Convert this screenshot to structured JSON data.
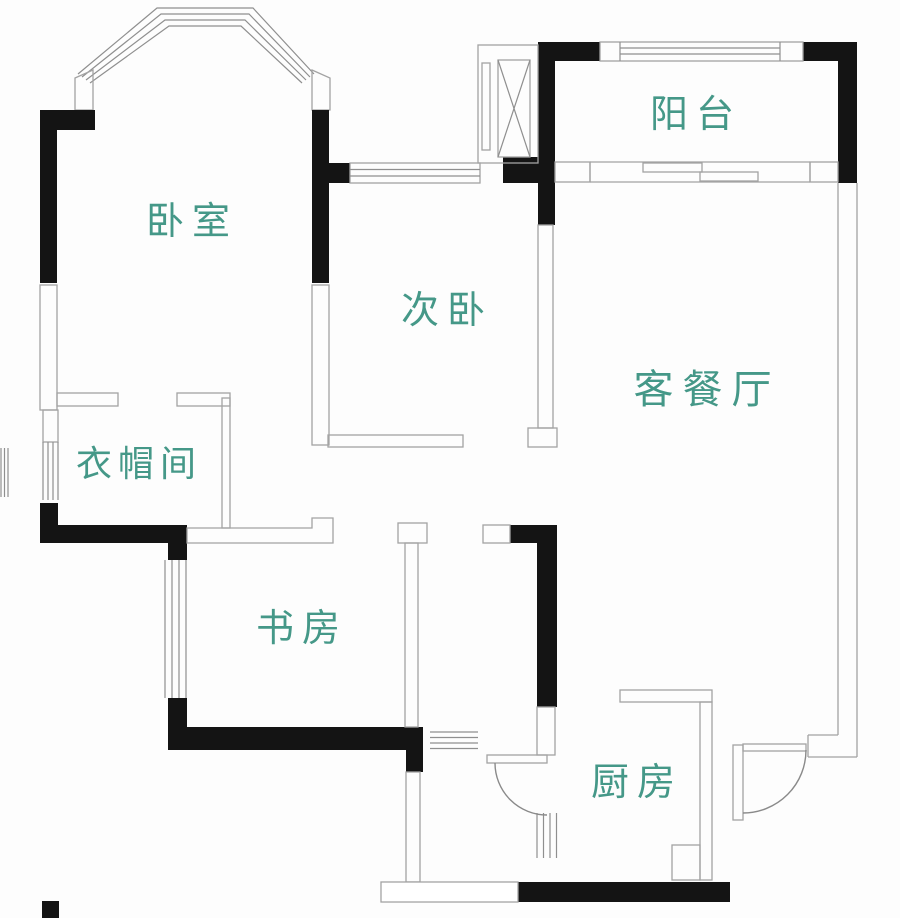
{
  "plan_title": "two-bedroom apartment floor plan",
  "colors": {
    "wall-color": "#141414",
    "line-color": "#a3a3a3",
    "label-color": "#459888",
    "bg-color": "#fdfdfd"
  },
  "rooms": [
    {
      "id": "master-bedroom",
      "name": "卧室"
    },
    {
      "id": "second-bedroom",
      "name": "次卧"
    },
    {
      "id": "balcony",
      "name": "阳台"
    },
    {
      "id": "living-dining",
      "name": "客餐厅"
    },
    {
      "id": "cloakroom",
      "name": "衣帽间"
    },
    {
      "id": "study",
      "name": "书房"
    },
    {
      "id": "kitchen",
      "name": "厨房"
    }
  ],
  "symbols": [
    {
      "id": "bay-window",
      "meaning": "bay window with four glazing lines"
    },
    {
      "id": "elevator-shaft",
      "meaning": "shaft box with X cross"
    },
    {
      "id": "swing-doors",
      "meaning": "quarter-circle door swings"
    },
    {
      "id": "sliding-door",
      "meaning": "balcony sliding door"
    }
  ]
}
